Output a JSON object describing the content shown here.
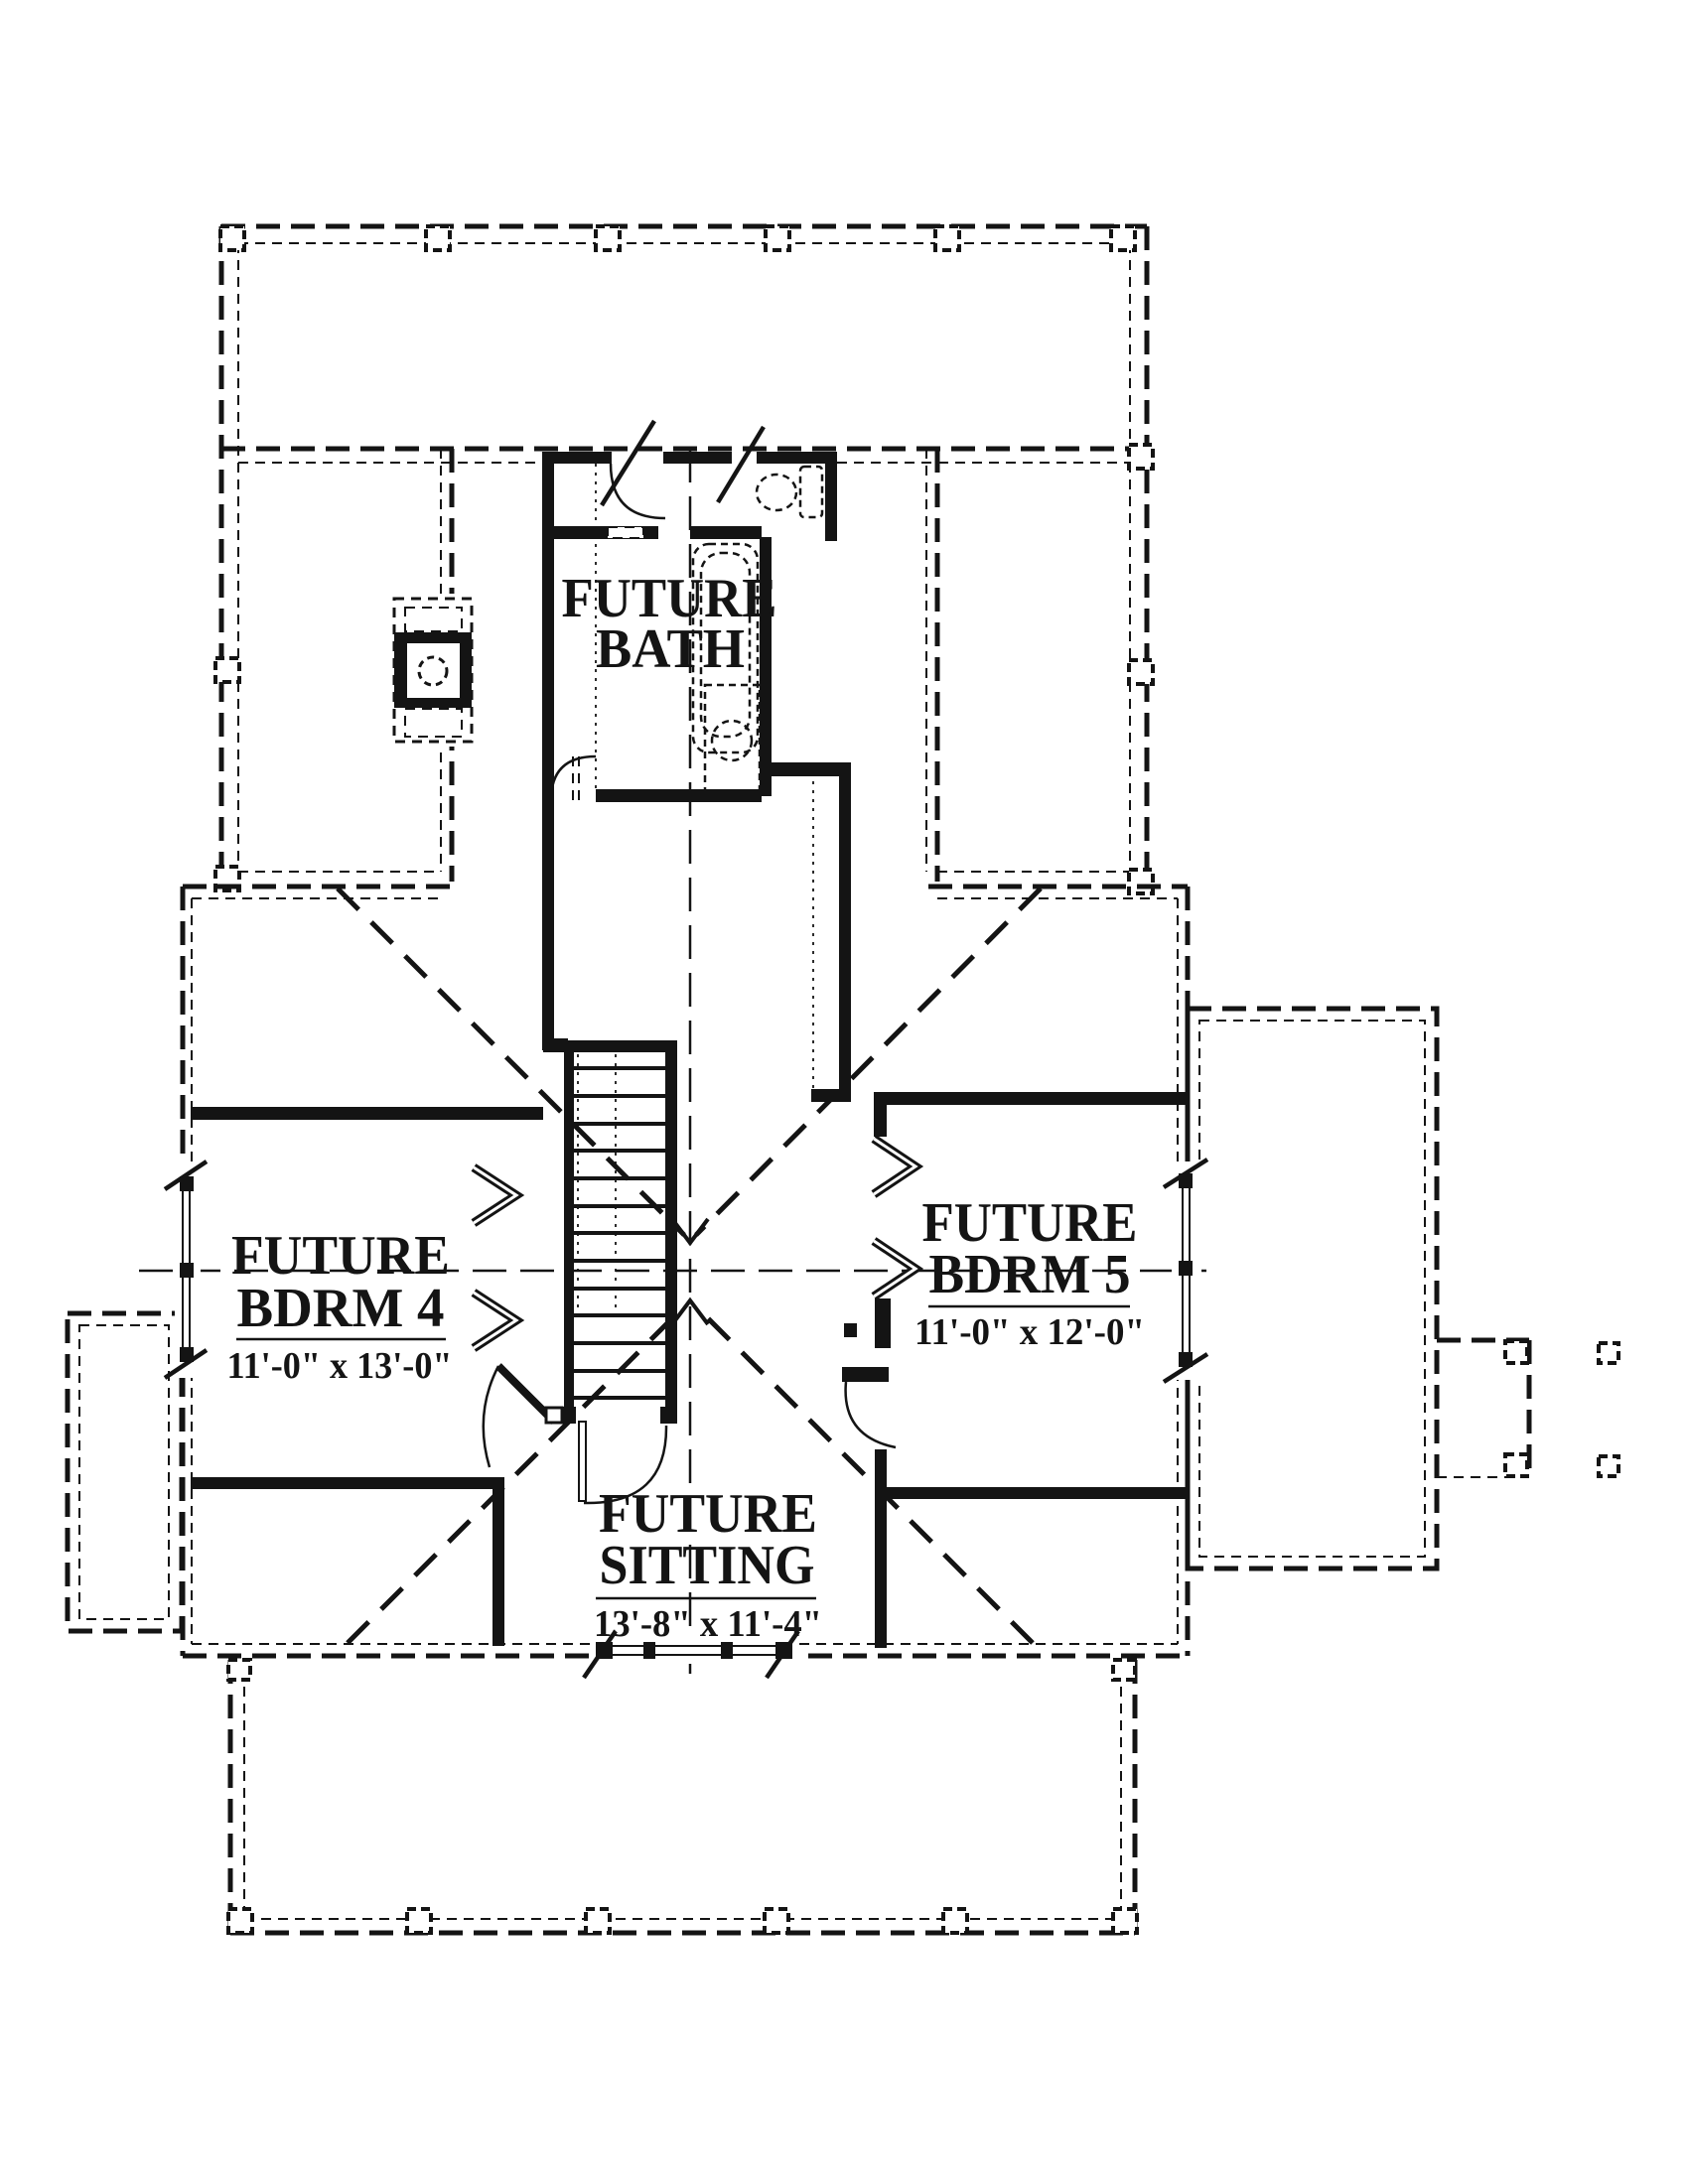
{
  "plan": {
    "title": "second floor plan",
    "ink_color": "#141414",
    "paper_color": "#ffffff",
    "rooms": {
      "bath": {
        "line1": "FUTURE",
        "line2": "BATH"
      },
      "bdrm4": {
        "line1": "FUTURE",
        "line2": "BDRM 4",
        "dims": "11'-0\" x 13'-0\""
      },
      "bdrm5": {
        "line1": "FUTURE",
        "line2": "BDRM 5",
        "dims": "11'-0\" x 12'-0\""
      },
      "sitting": {
        "line1": "FUTURE",
        "line2": "SITTING",
        "dims": "13'-8\" x 11'-4\""
      }
    }
  }
}
